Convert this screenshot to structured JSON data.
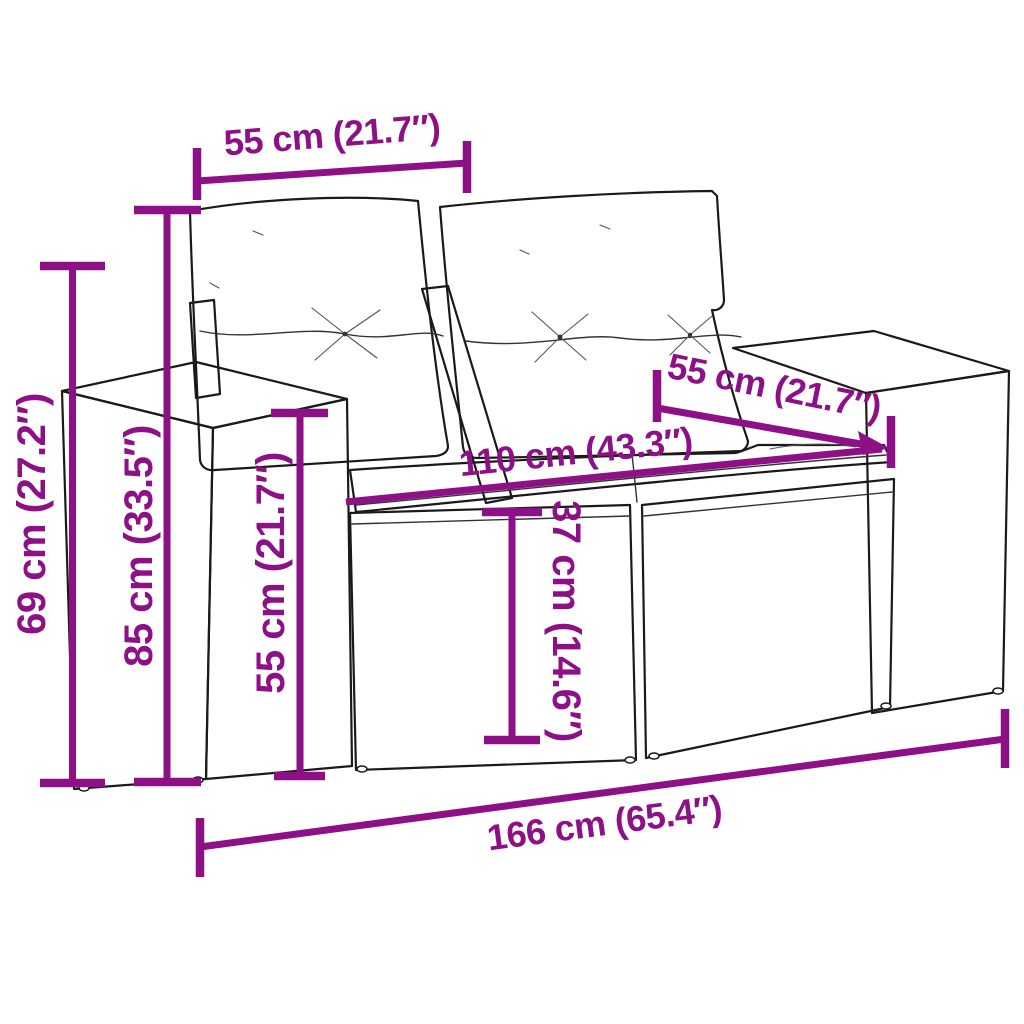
{
  "diagram": {
    "description": "Line-art dimension drawing of a poly rattan 2-seater garden sofa with back and seat cushions",
    "accent_color": "#8D1086",
    "line_color": "#1A1A1A",
    "background_color": "#FFFFFF",
    "dimensions": {
      "back_cushion_width": "55 cm (21.7″)",
      "seat_depth": "55 cm (21.7″)",
      "seat_width": "110 cm (43.3″)",
      "overall_height": "69 cm (27.2″)",
      "backrest_height": "85 cm (33.5″)",
      "armrest_height": "55 cm (21.7″)",
      "seat_height": "37 cm (14.6″)",
      "overall_width": "166 cm (65.4″)"
    }
  }
}
